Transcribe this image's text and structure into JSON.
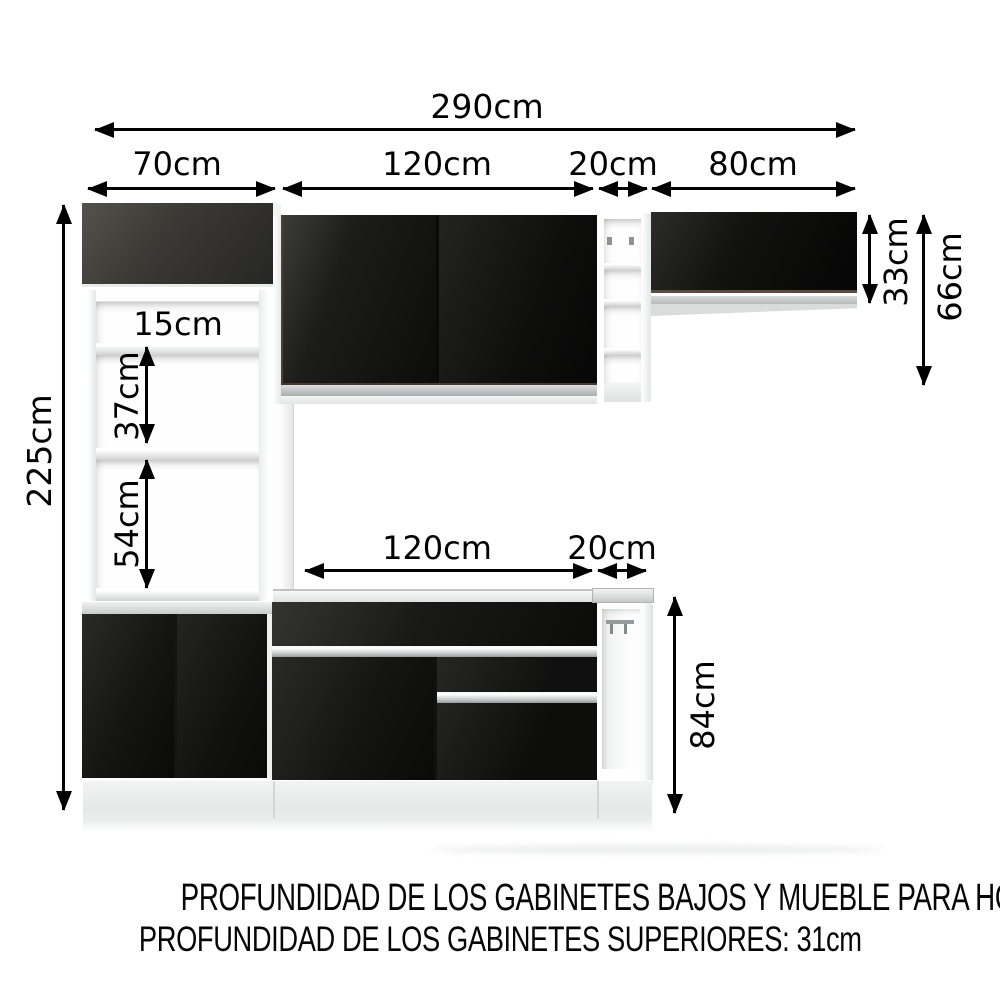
{
  "labels": {
    "total_width": "290cm",
    "tower_width": "70cm",
    "upper_cabinet_width": "120cm",
    "upper_shelf_width": "20cm",
    "upper_right_width": "80cm",
    "upper_right_door_height": "33cm",
    "upper_right_total_height": "66cm",
    "total_height": "225cm",
    "tower_gap_top": "15cm",
    "tower_gap_middle": "37cm",
    "tower_gap_bottom": "54cm",
    "base_run_width": "120cm",
    "base_end_width": "20cm",
    "base_height": "84cm"
  },
  "footer": {
    "line1": "PROFUNDIDAD DE LOS GABINETES BAJOS Y MUEBLE PARA HORNO: 52cm",
    "line2": "PROFUNDIDAD DE LOS GABINETES SUPERIORES: 31cm"
  },
  "colors": {
    "cabinet_black": "#161614",
    "tower_top_gray": "#45443f",
    "silver_handle": "#c9cecd",
    "countertop_gray": "#ced3d2",
    "carcass_white": "#ffffff",
    "dimension_text": "#000000"
  }
}
